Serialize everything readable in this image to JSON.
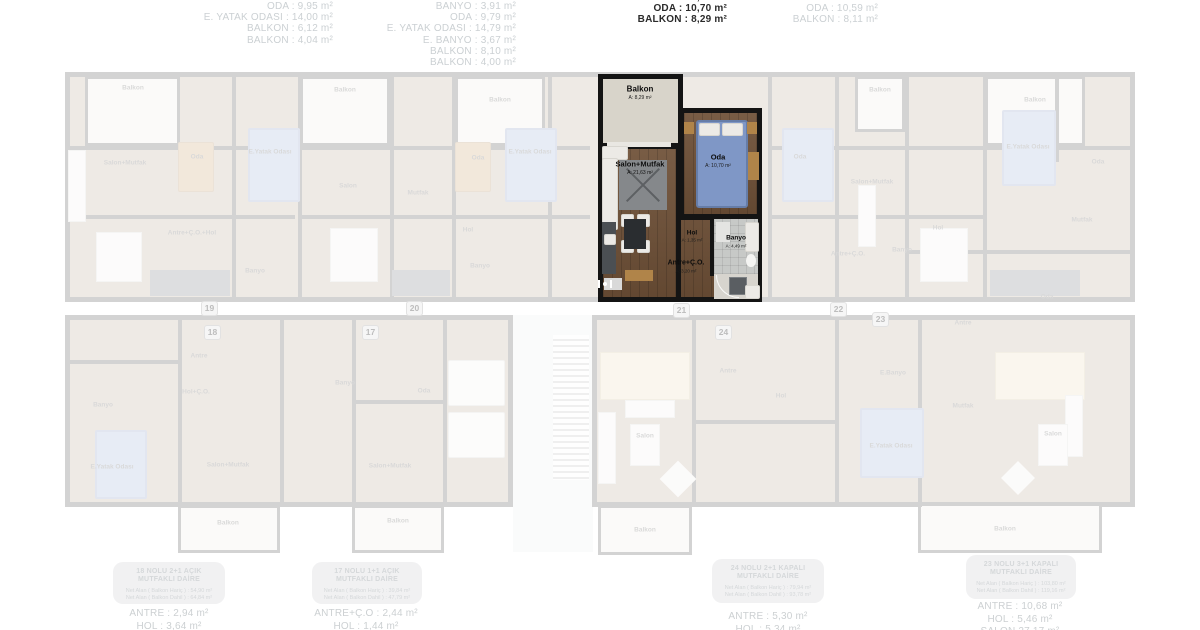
{
  "page": {
    "background": "#ffffff"
  },
  "top_measurements": {
    "columns": [
      {
        "unit": "19",
        "style": "faded",
        "lines": [
          "ODA : 9,95 m²",
          "E. YATAK ODASI : 14,00 m²",
          "BALKON : 6,12 m²",
          "BALKON : 4,04 m²"
        ]
      },
      {
        "unit": "20",
        "style": "faded",
        "lines": [
          "BANYO : 3,91 m²",
          "ODA : 9,79 m²",
          "E. YATAK ODASI : 14,79 m²",
          "E. BANYO : 3,67 m²",
          "BALKON : 8,10 m²",
          "BALKON : 4,00 m²"
        ]
      },
      {
        "unit": "21",
        "style": "bold",
        "first_line_clipped": true,
        "lines": [
          "BANYO : 4,49 m²",
          "ODA : 10,70 m²",
          "BALKON : 8,29 m²"
        ]
      },
      {
        "unit": "22",
        "style": "faded",
        "lines": [
          "ODA : 10,59 m²",
          "BALKON : 8,11 m²"
        ]
      }
    ]
  },
  "highlighted_unit": {
    "number": "21",
    "rooms": {
      "balkon": {
        "name": "Balkon",
        "area": "A: 8,29 m²"
      },
      "salon": {
        "name": "Salon+Mutfak",
        "area": "A: 21,63 m²"
      },
      "oda": {
        "name": "Oda",
        "area": "A: 10,70 m²"
      },
      "hol": {
        "name": "Hol",
        "area": "A: 1,35 m²"
      },
      "banyo": {
        "name": "Banyo",
        "area": "A: 4,49 m²"
      },
      "antre": {
        "name": "Antre+Ç.O.",
        "area": "A: 3,20 m²"
      }
    }
  },
  "unit_badges": [
    {
      "number": "19"
    },
    {
      "number": "20"
    },
    {
      "number": "18"
    },
    {
      "number": "17"
    },
    {
      "number": "21"
    },
    {
      "number": "22"
    },
    {
      "number": "24"
    },
    {
      "number": "23"
    }
  ],
  "faded_labels": [
    {
      "text": "Balkon"
    },
    {
      "text": "Balkon"
    },
    {
      "text": "Balkon"
    },
    {
      "text": "Balkon"
    },
    {
      "text": "Balkon"
    },
    {
      "text": "Salon+Mutfak"
    },
    {
      "text": "Oda"
    },
    {
      "text": "E.Yatak Odası"
    },
    {
      "text": "Antre+Ç.O.+Hol"
    },
    {
      "text": "Banyo"
    },
    {
      "text": "Salon"
    },
    {
      "text": "Mutfak"
    },
    {
      "text": "Oda"
    },
    {
      "text": "E.Yatak Odası"
    },
    {
      "text": "Hol"
    },
    {
      "text": "Banyo"
    },
    {
      "text": "Oda"
    },
    {
      "text": "Salon+Mutfak"
    },
    {
      "text": "Antre+Ç.O."
    },
    {
      "text": "Banyo"
    },
    {
      "text": "Hol"
    },
    {
      "text": "E.Yatak Odası"
    },
    {
      "text": "Oda"
    },
    {
      "text": "Mutfak"
    },
    {
      "text": "Oda"
    },
    {
      "text": "Antre"
    },
    {
      "text": "Banyo"
    },
    {
      "text": "E.Yatak Odası"
    },
    {
      "text": "Salon+Mutfak"
    },
    {
      "text": "Hol+Ç.O."
    },
    {
      "text": "Antre"
    },
    {
      "text": "Balkon"
    },
    {
      "text": "Banyo"
    },
    {
      "text": "Oda"
    },
    {
      "text": "Salon+Mutfak"
    },
    {
      "text": "Balkon"
    },
    {
      "text": "Antre"
    },
    {
      "text": "Hol"
    },
    {
      "text": "Salon"
    },
    {
      "text": "E.Banyo"
    },
    {
      "text": "E.Yatak Odası"
    },
    {
      "text": "Balkon"
    },
    {
      "text": "Mutfak"
    },
    {
      "text": "Salon"
    },
    {
      "text": "Balkon"
    }
  ],
  "bottom_info": {
    "boxes": [
      {
        "title_lines": [
          "18 NOLU 2+1 AÇIK",
          "MUTFAKLI DAİRE"
        ],
        "net_lines": [
          "Net Alan ( Balkon Hariç ) : 54,90 m²",
          "Net Alan ( Balkon Dahil ) : 64,84 m²"
        ],
        "measure_lines": [
          "ANTRE : 2,94 m²",
          "HOL : 3,64 m²"
        ]
      },
      {
        "title_lines": [
          "17 NOLU 1+1 AÇIK",
          "MUTFAKLI DAİRE"
        ],
        "net_lines": [
          "Net Alan ( Balkon Hariç ) : 39,84 m²",
          "Net Alan ( Balkon Dahil ) : 47,79 m²"
        ],
        "measure_lines": [
          "ANTRE+Ç.O : 2,44 m²",
          "HOL : 1,44 m²"
        ]
      },
      {
        "title_lines": [
          "24 NOLU 2+1 KAPALI",
          "MUTFAKLI DAİRE"
        ],
        "net_lines": [
          "Net Alan ( Balkon Hariç ) : 79,94 m²",
          "Net Alan ( Balkon Dahil ) : 93,78 m²"
        ],
        "measure_lines": [
          "ANTRE : 5,30 m²",
          "HOL : 5,34 m²"
        ]
      },
      {
        "title_lines": [
          "23 NOLU 3+1 KAPALI",
          "MUTFAKLI DAİRE"
        ],
        "net_lines": [
          "Net Alan ( Balkon Hariç ) : 103,80 m²",
          "Net Alan ( Balkon Dahil ) : 119,16 m²"
        ],
        "measure_lines": [
          "ANTRE : 10,68 m²",
          "HOL : 5,46 m²",
          "SALON 27,17 m²"
        ]
      }
    ]
  },
  "colors": {
    "highlight_wall": "#141414",
    "wood_floor": "#6e5037",
    "bed_blue": "#7f97c6",
    "faded_text": "#cbd0d3",
    "bold_text": "#2b2b2b"
  }
}
